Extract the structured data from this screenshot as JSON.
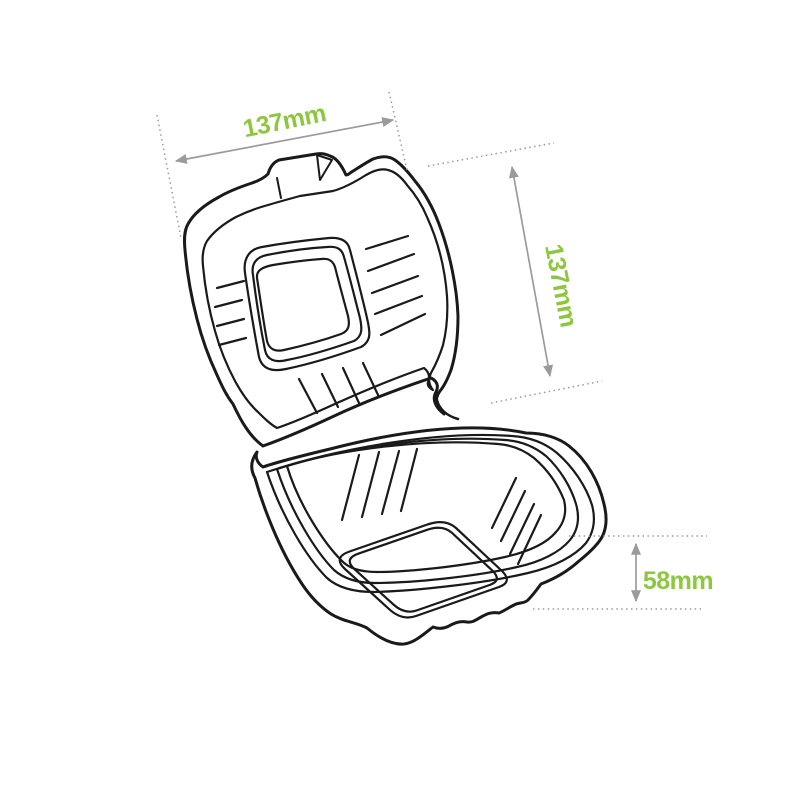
{
  "illustration": {
    "description": "Line drawing of an open clamshell takeaway burger box with lid raised"
  },
  "dimensions": {
    "width": {
      "label": "137mm"
    },
    "depth": {
      "label": "137mm"
    },
    "height": {
      "label": "58mm"
    }
  },
  "colors": {
    "label_green": "#8DC63F",
    "dimension_gray": "#9B9B9B",
    "line_art": "#1A1A1A",
    "background": "#FFFFFF"
  }
}
